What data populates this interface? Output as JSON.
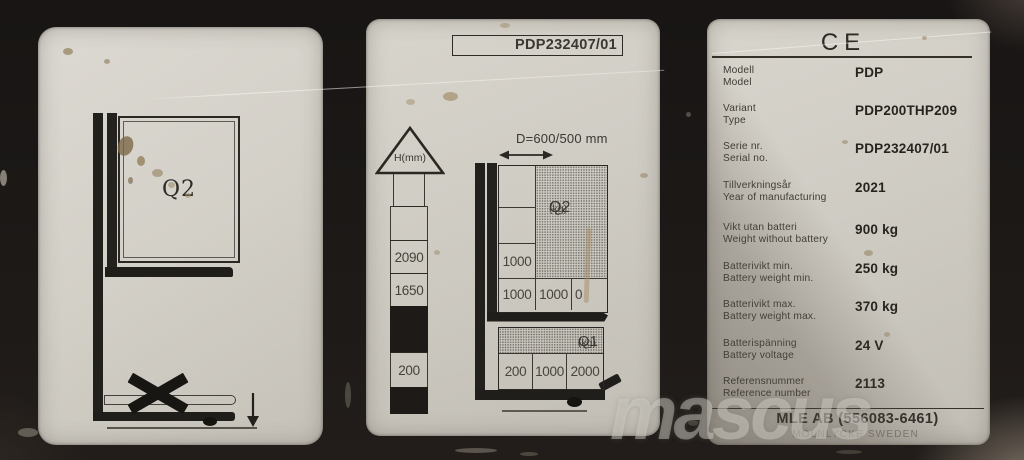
{
  "watermark": "mascus",
  "left_plate": {
    "load_label": "Q2"
  },
  "middle_plate": {
    "serial_box": "PDP232407/01",
    "height_scale": {
      "unit": "H(mm)",
      "values": [
        "2090",
        "1650",
        "200"
      ]
    },
    "distance_label": "D=600/500 mm",
    "q2_table": {
      "name": "Q2",
      "unit": "(kg)",
      "column_value": "1000",
      "bottom_row": [
        "1000",
        "1000",
        "0"
      ]
    },
    "q1_table": {
      "name": "Q1",
      "unit": "(kg)",
      "bottom_row": [
        "200",
        "1000",
        "2000"
      ]
    }
  },
  "right_plate": {
    "ce_mark": "CE",
    "rows": [
      {
        "sv": "Modell",
        "en": "Model",
        "value": "PDP"
      },
      {
        "sv": "Variant",
        "en": "Type",
        "value": "PDP200THP209"
      },
      {
        "sv": "Serie nr.",
        "en": "Serial no.",
        "value": "PDP232407/01"
      },
      {
        "sv": "Tillverkningsår",
        "en": "Year of manufacturing",
        "value": "2021"
      },
      {
        "sv": "Vikt utan batteri",
        "en": "Weight without battery",
        "value": "900 kg"
      },
      {
        "sv": "Batterivikt min.",
        "en": "Battery weight min.",
        "value": "250 kg"
      },
      {
        "sv": "Batterivikt max.",
        "en": "Battery weight max.",
        "value": "370 kg"
      },
      {
        "sv": "Batterispänning",
        "en": "Battery voltage",
        "value": "24 V"
      },
      {
        "sv": "Referensnummer",
        "en": "Reference number",
        "value": "2113"
      }
    ],
    "manufacturer": "MLE AB (556083-6461)",
    "address": "MÖLNLYCKE SWEDEN"
  }
}
